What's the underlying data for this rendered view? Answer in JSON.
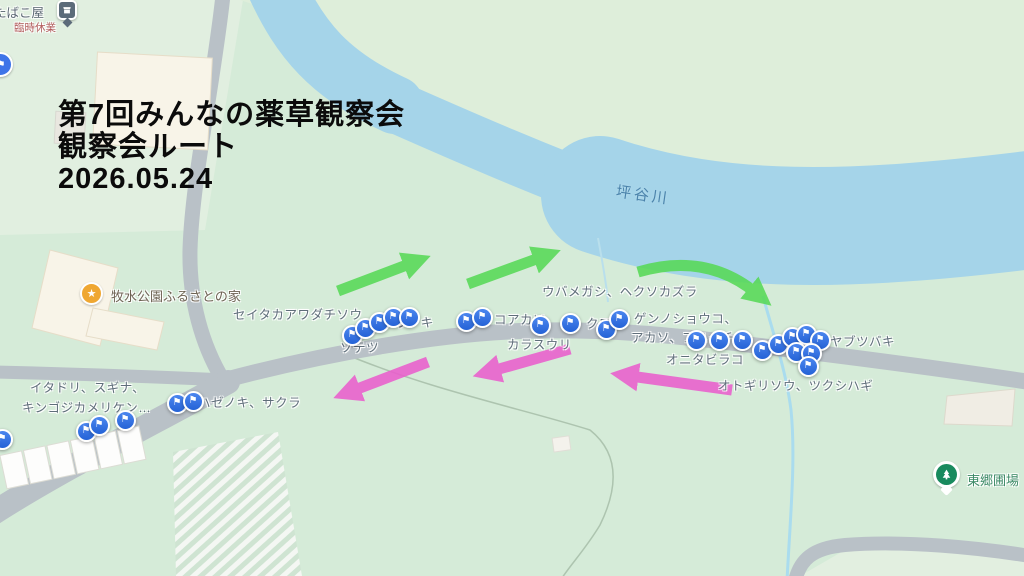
{
  "overlay": {
    "title_lines": [
      "第7回みんなの薬草観察会",
      "観察会ルート",
      "2026.05.24"
    ]
  },
  "map": {
    "river_label": {
      "text": "坪谷川"
    },
    "pois": {
      "house": {
        "label": "牧水公園ふるさとの家",
        "icon": "star-icon"
      },
      "field": {
        "label": "東郷圃場",
        "icon": "tree-icon"
      },
      "shop": {
        "label": "たばこ屋",
        "status": "臨時休業",
        "icon": "shop-pin"
      }
    },
    "plant_labels": [
      {
        "text": "セイタカアワダチソウ",
        "x": 233,
        "y": 304
      },
      {
        "text": "タラノキ",
        "x": 382,
        "y": 312
      },
      {
        "text": "ソテツ",
        "x": 340,
        "y": 337
      },
      {
        "text": "コアカソ",
        "x": 494,
        "y": 309
      },
      {
        "text": "カラスウリ",
        "x": 507,
        "y": 334
      },
      {
        "text": "ウバメガシ、ヘクソカズラ",
        "x": 542,
        "y": 281
      },
      {
        "text": "クワ、",
        "x": 586,
        "y": 313
      },
      {
        "text": "ゲンノショウコ、",
        "x": 634,
        "y": 308
      },
      {
        "text": "アカソ、フユイチゴ",
        "x": 631,
        "y": 327
      },
      {
        "text": "オニタビラコ",
        "x": 666,
        "y": 349
      },
      {
        "text": "ヤブツバキ",
        "x": 830,
        "y": 331
      },
      {
        "text": "オトギリソウ、ツクシハギ",
        "x": 718,
        "y": 375
      },
      {
        "text": "イタドリ、スギナ、",
        "x": 30,
        "y": 377
      },
      {
        "text": "キンゴジカメリケン…",
        "x": 22,
        "y": 397
      },
      {
        "text": "ハゼノキ、サクラ",
        "x": 198,
        "y": 392
      }
    ],
    "markers": [
      {
        "x": 352,
        "y": 335
      },
      {
        "x": 365,
        "y": 328
      },
      {
        "x": 379,
        "y": 322
      },
      {
        "x": 393,
        "y": 317
      },
      {
        "x": 409,
        "y": 317
      },
      {
        "x": 466,
        "y": 321
      },
      {
        "x": 482,
        "y": 317
      },
      {
        "x": 540,
        "y": 325
      },
      {
        "x": 570,
        "y": 323
      },
      {
        "x": 606,
        "y": 329
      },
      {
        "x": 619,
        "y": 319
      },
      {
        "x": 696,
        "y": 340
      },
      {
        "x": 719,
        "y": 340
      },
      {
        "x": 742,
        "y": 340
      },
      {
        "x": 762,
        "y": 350
      },
      {
        "x": 778,
        "y": 344
      },
      {
        "x": 792,
        "y": 337
      },
      {
        "x": 806,
        "y": 334
      },
      {
        "x": 820,
        "y": 340
      },
      {
        "x": 796,
        "y": 352
      },
      {
        "x": 811,
        "y": 353
      },
      {
        "x": 808,
        "y": 366
      },
      {
        "x": 2,
        "y": 439
      },
      {
        "x": 86,
        "y": 431
      },
      {
        "x": 99,
        "y": 425
      },
      {
        "x": 125,
        "y": 420
      },
      {
        "x": 177,
        "y": 403
      },
      {
        "x": 193,
        "y": 401
      }
    ],
    "arrows": {
      "green": [
        {
          "x1": 338,
          "y1": 291,
          "x2": 412,
          "y2": 263
        },
        {
          "x1": 468,
          "y1": 284,
          "x2": 542,
          "y2": 257
        },
        {
          "x1": 638,
          "y1": 272,
          "cx": 706,
          "cy": 252,
          "x2": 756,
          "y2": 293
        }
      ],
      "pink": [
        {
          "x1": 428,
          "y1": 362,
          "x2": 352,
          "y2": 391
        },
        {
          "x1": 570,
          "y1": 349,
          "x2": 492,
          "y2": 371
        },
        {
          "x1": 732,
          "y1": 390,
          "x2": 630,
          "y2": 376
        }
      ]
    },
    "colors": {
      "arrow_green": "#57d957",
      "arrow_pink": "#ea5ecd",
      "marker_blue": "#2f6ce0",
      "river": "#a5d4e9",
      "road": "#b9c1c7",
      "park_green": "#d5ebd8"
    }
  }
}
